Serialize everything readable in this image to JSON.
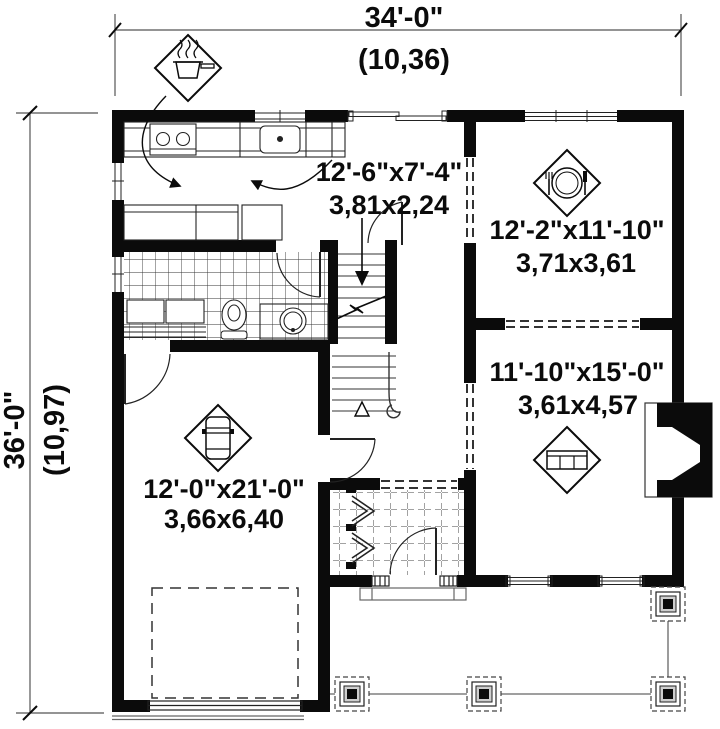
{
  "plan": {
    "type": "floor-plan",
    "colors": {
      "wall": "#0b0b0b",
      "line": "#222222",
      "light_line": "#666666",
      "bg": "#ffffff"
    },
    "dimensions": {
      "top": {
        "imperial": "34'-0\"",
        "metric": "(10,36)"
      },
      "left": {
        "imperial": "36'-0\"",
        "metric": "(10,97)"
      }
    },
    "rooms": [
      {
        "id": "kitchen",
        "imperial": "12'-6\"x7'-4\"",
        "metric": "3,81x2,24",
        "icon": "cooking-pot-icon"
      },
      {
        "id": "dining",
        "imperial": "12'-2\"x11'-10\"",
        "metric": "3,71x3,61",
        "icon": "dining-plate-icon"
      },
      {
        "id": "living",
        "imperial": "11'-10\"x15'-0\"",
        "metric": "3,61x4,57",
        "icon": "sofa-icon"
      },
      {
        "id": "garage",
        "imperial": "12'-0\"x21'-0\"",
        "metric": "3,66x6,40",
        "icon": "car-icon"
      }
    ]
  }
}
